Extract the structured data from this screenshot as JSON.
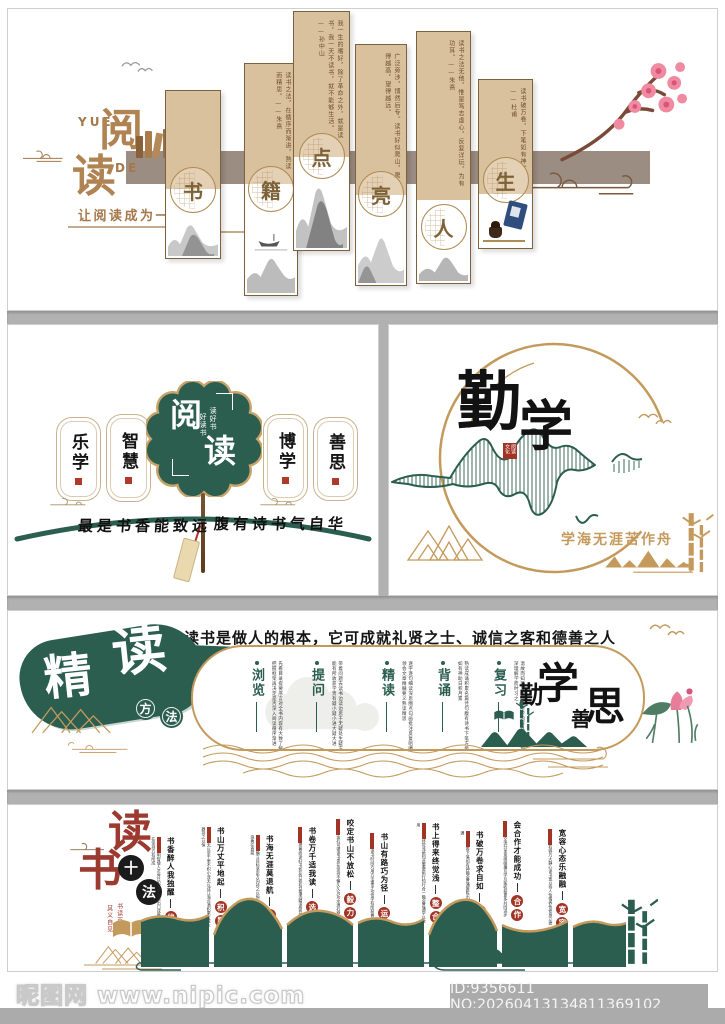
{
  "accent_colors": {
    "green": "#2c5e50",
    "gold": "#c49a5c",
    "tan": "#dac19d",
    "brown": "#a5784a",
    "red": "#a23425",
    "dark_red": "#9c3a30",
    "taupe": "#9c8d82"
  },
  "panel1": {
    "logo": {
      "yue": "YUE",
      "de": "DE",
      "read1": "阅",
      "read2": "读"
    },
    "tagline": "让阅读成为一种习惯",
    "banners": [
      {
        "char": "书",
        "quote": ""
      },
      {
        "char": "籍",
        "quote": "读书之法，在循序而渐进，熟读而精思。——朱熹"
      },
      {
        "char": "点",
        "quote": "我一生的嗜好，除了革命之外，就是读书，我一天不读书，就不能够生活。——孙中山"
      },
      {
        "char": "亮",
        "quote": "广泛旁涉，博然后专。读书好似爬山，爬得越高，望得越远。"
      },
      {
        "char": "人",
        "quote": "读书之法无他，惟是笃志虚心，反复详玩，为有功耳。——朱熹"
      },
      {
        "char": "生",
        "quote": "读书破万卷，下笔如有神。——杜甫"
      }
    ]
  },
  "panel2_left": {
    "fan": {
      "char1": "阅",
      "char2": "读",
      "sub1": "读好书",
      "sub2": "好读书"
    },
    "tablets": [
      "乐学",
      "智慧",
      "博学",
      "善思"
    ],
    "calligraphy_left": "最是书香能致远",
    "calligraphy_right": "腹有诗书气自华"
  },
  "panel2_right": {
    "char1": "勤",
    "char2": "学",
    "seal": "阅读文化",
    "motto": "学海无涯苦作舟"
  },
  "panel3": {
    "headline": "读书是做人的根本，它可成就礼贤之士、诚信之客和德善之人",
    "title_char1": "精",
    "title_char2": "读",
    "circle1": "方",
    "circle2": "法",
    "methods": [
      {
        "label": "浏览",
        "desc": "先看目录提要序言对全书内容有大致了解把握框架再决定是否深入阅读循序渐进"
      },
      {
        "label": "提问",
        "desc": "带着问题去读书边读边思于无疑处生疑方能有所收获学贵有疑小疑小进大疑大进"
      },
      {
        "label": "精读",
        "desc": "逐字逐句细读深思圈点勾画批注反复咀嚼领会文章精髓要义熟读精思"
      },
      {
        "label": "背诵",
        "desc": "熟读成诵积累名篇佳句腹有诗书下笔方能如有神助日积月累"
      },
      {
        "label": "复习",
        "desc": "温故而知新及时回顾所学内容巩固记忆加深理解学而时习之"
      }
    ],
    "slogan": {
      "c1": "勤",
      "c2": "学",
      "c3": "善",
      "c4": "思"
    }
  },
  "panel4": {
    "title_char1": "读",
    "title_char2": "书",
    "circle1": "十",
    "circle2": "法",
    "sub1": "书读百遍",
    "sub2": "其义自见",
    "items": [
      {
        "phrase": "书香醉人我独醒",
        "l1": "优",
        "l2": "势",
        "desc": "读书使人明智使人灵秀日积月累自然出口成章开卷有益贵在坚持方有所成"
      },
      {
        "phrase": "书山万丈平地起",
        "l1": "积",
        "l2": "累",
        "desc": "不积跬步无以至千里不积小流无以成江海点滴积累方成大器持之以恒"
      },
      {
        "phrase": "书海无涯莫退航",
        "l1": "方",
        "l2": "向",
        "desc": "学海无涯确立目标坚定方向持之以恒方能学有所成不惧风浪勇往直前"
      },
      {
        "phrase": "书卷万千适我读",
        "l1": "选",
        "l2": "择",
        "desc": "书有良莠择善而读好书如友开卷有益慎选精读受益终身"
      },
      {
        "phrase": "咬定书山不放松",
        "l1": "毅",
        "l2": "力",
        "desc": "锲而不舍金石可镂读书贵在坚持不懈久久为功水滴石穿"
      },
      {
        "phrase": "书山有路巧为径",
        "l1": "运",
        "l2": "筹",
        "desc": "统筹安排读书时间巧用方法事半功倍学有所获善作规划"
      },
      {
        "phrase": "书上得来终觉浅",
        "l1": "整",
        "l2": "合",
        "desc": "纸上得来终觉浅绝知此事要躬行知行合一融会贯通学以致用"
      },
      {
        "phrase": "书破万卷求自如",
        "l1": "创",
        "l2": "新",
        "desc": "读书破万卷下笔如有神融会贯通推陈出新举一反三触类旁通"
      },
      {
        "phrase": "会合作才能成功",
        "l1": "合",
        "l2": "作",
        "desc": "与人共读交流分享思维碰撞互学互鉴收获更多共同进步"
      },
      {
        "phrase": "宽容心态乐融融",
        "l1": "宽",
        "l2": "容",
        "desc": "海纳百川有容乃大静心读书宽以待人怡情养性修身立德"
      }
    ]
  },
  "watermark": {
    "site": "昵图网 www.nipic.com",
    "id_text": "ID:9356611 NO:20260413134811369102"
  }
}
